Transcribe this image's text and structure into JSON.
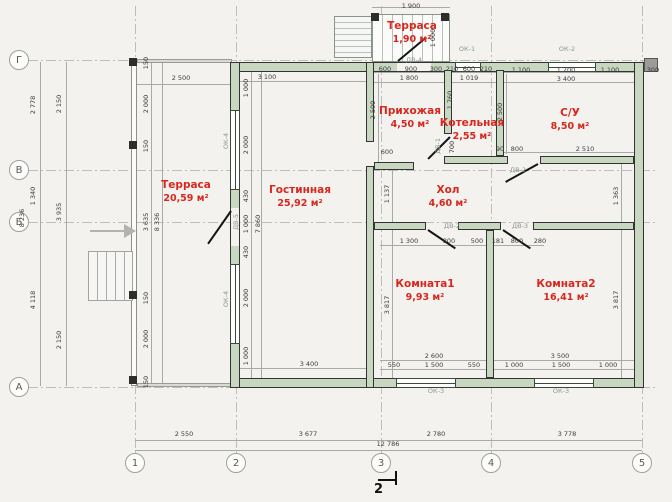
{
  "palette": {
    "paper": "#f3f2ef",
    "wall_fill": "#c7d7c0",
    "wall_stroke": "#333333",
    "room_label": "#d8281e",
    "dim_text": "#3c3c3c",
    "line_gray": "#9a9a9a",
    "opening_label": "#8c968c"
  },
  "axes": {
    "rows": [
      {
        "label": "Г",
        "y": 60
      },
      {
        "label": "В",
        "y": 170
      },
      {
        "label": "Б",
        "y": 222
      },
      {
        "label": "А",
        "y": 387
      }
    ],
    "cols": [
      {
        "label": "1",
        "x": 135
      },
      {
        "label": "2",
        "x": 236
      },
      {
        "label": "3",
        "x": 381
      },
      {
        "label": "4",
        "x": 491
      },
      {
        "label": "5",
        "x": 642
      }
    ]
  },
  "rooms": [
    {
      "name": "Терраса",
      "area": "1,90 м²",
      "x": 412,
      "y": 33
    },
    {
      "name": "Прихожая",
      "area": "4,50 м²",
      "x": 410,
      "y": 118
    },
    {
      "name": "Котельная",
      "area": "2,55 м²",
      "x": 472,
      "y": 130
    },
    {
      "name": "С/У",
      "area": "8,50 м²",
      "x": 570,
      "y": 120
    },
    {
      "name": "Терраса",
      "area": "20,59 м²",
      "x": 186,
      "y": 192
    },
    {
      "name": "Гостинная",
      "area": "25,92 м²",
      "x": 300,
      "y": 197
    },
    {
      "name": "Хол",
      "area": "4,60 м²",
      "x": 448,
      "y": 197
    },
    {
      "name": "Комната1",
      "area": "9,93 м²",
      "x": 425,
      "y": 291
    },
    {
      "name": "Комната2",
      "area": "16,41 м²",
      "x": 566,
      "y": 291
    }
  ],
  "openings": [
    {
      "t": "ОК-1",
      "x": 467,
      "y": 49
    },
    {
      "t": "ОК-2",
      "x": 567,
      "y": 49
    },
    {
      "t": "ОК-3",
      "x": 436,
      "y": 391
    },
    {
      "t": "ОК-3",
      "x": 561,
      "y": 391
    },
    {
      "t": "ОК-4",
      "x": 226,
      "y": 141,
      "v": 1
    },
    {
      "t": "ОК-4",
      "x": 226,
      "y": 299,
      "v": 1
    },
    {
      "t": "ДВ-4",
      "x": 414,
      "y": 60
    },
    {
      "t": "ДВ-5",
      "x": 236,
      "y": 222,
      "v": 1
    },
    {
      "t": "ДВ-1",
      "x": 438,
      "y": 146,
      "v": 1
    },
    {
      "t": "ДВ-2",
      "x": 518,
      "y": 170
    },
    {
      "t": "ДВ-2",
      "x": 452,
      "y": 226
    },
    {
      "t": "ДВ-3",
      "x": 520,
      "y": 226
    }
  ],
  "dims": [
    {
      "t": "1 900",
      "x": 411,
      "y": 6
    },
    {
      "t": "1 000",
      "x": 433,
      "y": 38,
      "v": 1
    },
    {
      "t": "600",
      "x": 385,
      "y": 69
    },
    {
      "t": "900",
      "x": 411,
      "y": 69
    },
    {
      "t": "300",
      "x": 436,
      "y": 69
    },
    {
      "t": "1 800",
      "x": 409,
      "y": 78
    },
    {
      "t": "210",
      "x": 452,
      "y": 69
    },
    {
      "t": "600",
      "x": 469,
      "y": 69
    },
    {
      "t": "210",
      "x": 486,
      "y": 69
    },
    {
      "t": "1 019",
      "x": 469,
      "y": 78
    },
    {
      "t": "1 100",
      "x": 521,
      "y": 70
    },
    {
      "t": "1 200",
      "x": 566,
      "y": 70
    },
    {
      "t": "1 100",
      "x": 610,
      "y": 70
    },
    {
      "t": "3 400",
      "x": 566,
      "y": 79
    },
    {
      "t": "300",
      "x": 653,
      "y": 70
    },
    {
      "t": "2 500",
      "x": 181,
      "y": 78
    },
    {
      "t": "3 100",
      "x": 267,
      "y": 77
    },
    {
      "t": "2 778",
      "x": 33,
      "y": 105,
      "v": 1
    },
    {
      "t": "1 340",
      "x": 33,
      "y": 196,
      "v": 1
    },
    {
      "t": "4 118",
      "x": 33,
      "y": 300,
      "v": 1
    },
    {
      "t": "8 236",
      "x": 22,
      "y": 218,
      "v": 1
    },
    {
      "t": "2 150",
      "x": 59,
      "y": 104,
      "v": 1
    },
    {
      "t": "3 935",
      "x": 59,
      "y": 212,
      "v": 1
    },
    {
      "t": "2 150",
      "x": 59,
      "y": 340,
      "v": 1
    },
    {
      "t": "150",
      "x": 146,
      "y": 63,
      "v": 1
    },
    {
      "t": "2 000",
      "x": 146,
      "y": 104,
      "v": 1
    },
    {
      "t": "150",
      "x": 146,
      "y": 146,
      "v": 1
    },
    {
      "t": "3 635",
      "x": 146,
      "y": 222,
      "v": 1
    },
    {
      "t": "8 336",
      "x": 157,
      "y": 222,
      "v": 1
    },
    {
      "t": "150",
      "x": 146,
      "y": 298,
      "v": 1
    },
    {
      "t": "2 000",
      "x": 146,
      "y": 339,
      "v": 1
    },
    {
      "t": "150",
      "x": 146,
      "y": 382,
      "v": 1
    },
    {
      "t": "1 000",
      "x": 246,
      "y": 88,
      "v": 1
    },
    {
      "t": "2 000",
      "x": 246,
      "y": 145,
      "v": 1
    },
    {
      "t": "430",
      "x": 246,
      "y": 196,
      "v": 1
    },
    {
      "t": "1 000",
      "x": 246,
      "y": 224,
      "v": 1
    },
    {
      "t": "430",
      "x": 246,
      "y": 252,
      "v": 1
    },
    {
      "t": "2 000",
      "x": 246,
      "y": 298,
      "v": 1
    },
    {
      "t": "1 000",
      "x": 246,
      "y": 356,
      "v": 1
    },
    {
      "t": "7 860",
      "x": 258,
      "y": 224,
      "v": 1
    },
    {
      "t": "2 500",
      "x": 373,
      "y": 110,
      "v": 1
    },
    {
      "t": "1 760",
      "x": 450,
      "y": 100,
      "v": 1
    },
    {
      "t": "700",
      "x": 452,
      "y": 147,
      "v": 1
    },
    {
      "t": "2 500",
      "x": 500,
      "y": 112,
      "v": 1
    },
    {
      "t": "600",
      "x": 387,
      "y": 152
    },
    {
      "t": "90",
      "x": 500,
      "y": 149
    },
    {
      "t": "800",
      "x": 517,
      "y": 149
    },
    {
      "t": "2 510",
      "x": 585,
      "y": 149
    },
    {
      "t": "1 137",
      "x": 387,
      "y": 194,
      "v": 1
    },
    {
      "t": "1 363",
      "x": 616,
      "y": 196,
      "v": 1
    },
    {
      "t": "1 300",
      "x": 409,
      "y": 241
    },
    {
      "t": "800",
      "x": 449,
      "y": 241
    },
    {
      "t": "500",
      "x": 477,
      "y": 241
    },
    {
      "t": "181",
      "x": 498,
      "y": 241
    },
    {
      "t": "800",
      "x": 517,
      "y": 241
    },
    {
      "t": "280",
      "x": 540,
      "y": 241
    },
    {
      "t": "3 817",
      "x": 387,
      "y": 305,
      "v": 1
    },
    {
      "t": "3 817",
      "x": 616,
      "y": 300,
      "v": 1
    },
    {
      "t": "3 400",
      "x": 309,
      "y": 364
    },
    {
      "t": "2 600",
      "x": 434,
      "y": 356
    },
    {
      "t": "550",
      "x": 394,
      "y": 365
    },
    {
      "t": "1 500",
      "x": 434,
      "y": 365
    },
    {
      "t": "550",
      "x": 474,
      "y": 365
    },
    {
      "t": "3 500",
      "x": 560,
      "y": 356
    },
    {
      "t": "1 000",
      "x": 514,
      "y": 365
    },
    {
      "t": "1 500",
      "x": 561,
      "y": 365
    },
    {
      "t": "1 000",
      "x": 608,
      "y": 365
    },
    {
      "t": "2 550",
      "x": 184,
      "y": 434
    },
    {
      "t": "3 677",
      "x": 308,
      "y": 434
    },
    {
      "t": "2 780",
      "x": 436,
      "y": 434
    },
    {
      "t": "3 778",
      "x": 567,
      "y": 434
    },
    {
      "t": "12 786",
      "x": 388,
      "y": 444
    }
  ],
  "section": {
    "label": "2"
  }
}
